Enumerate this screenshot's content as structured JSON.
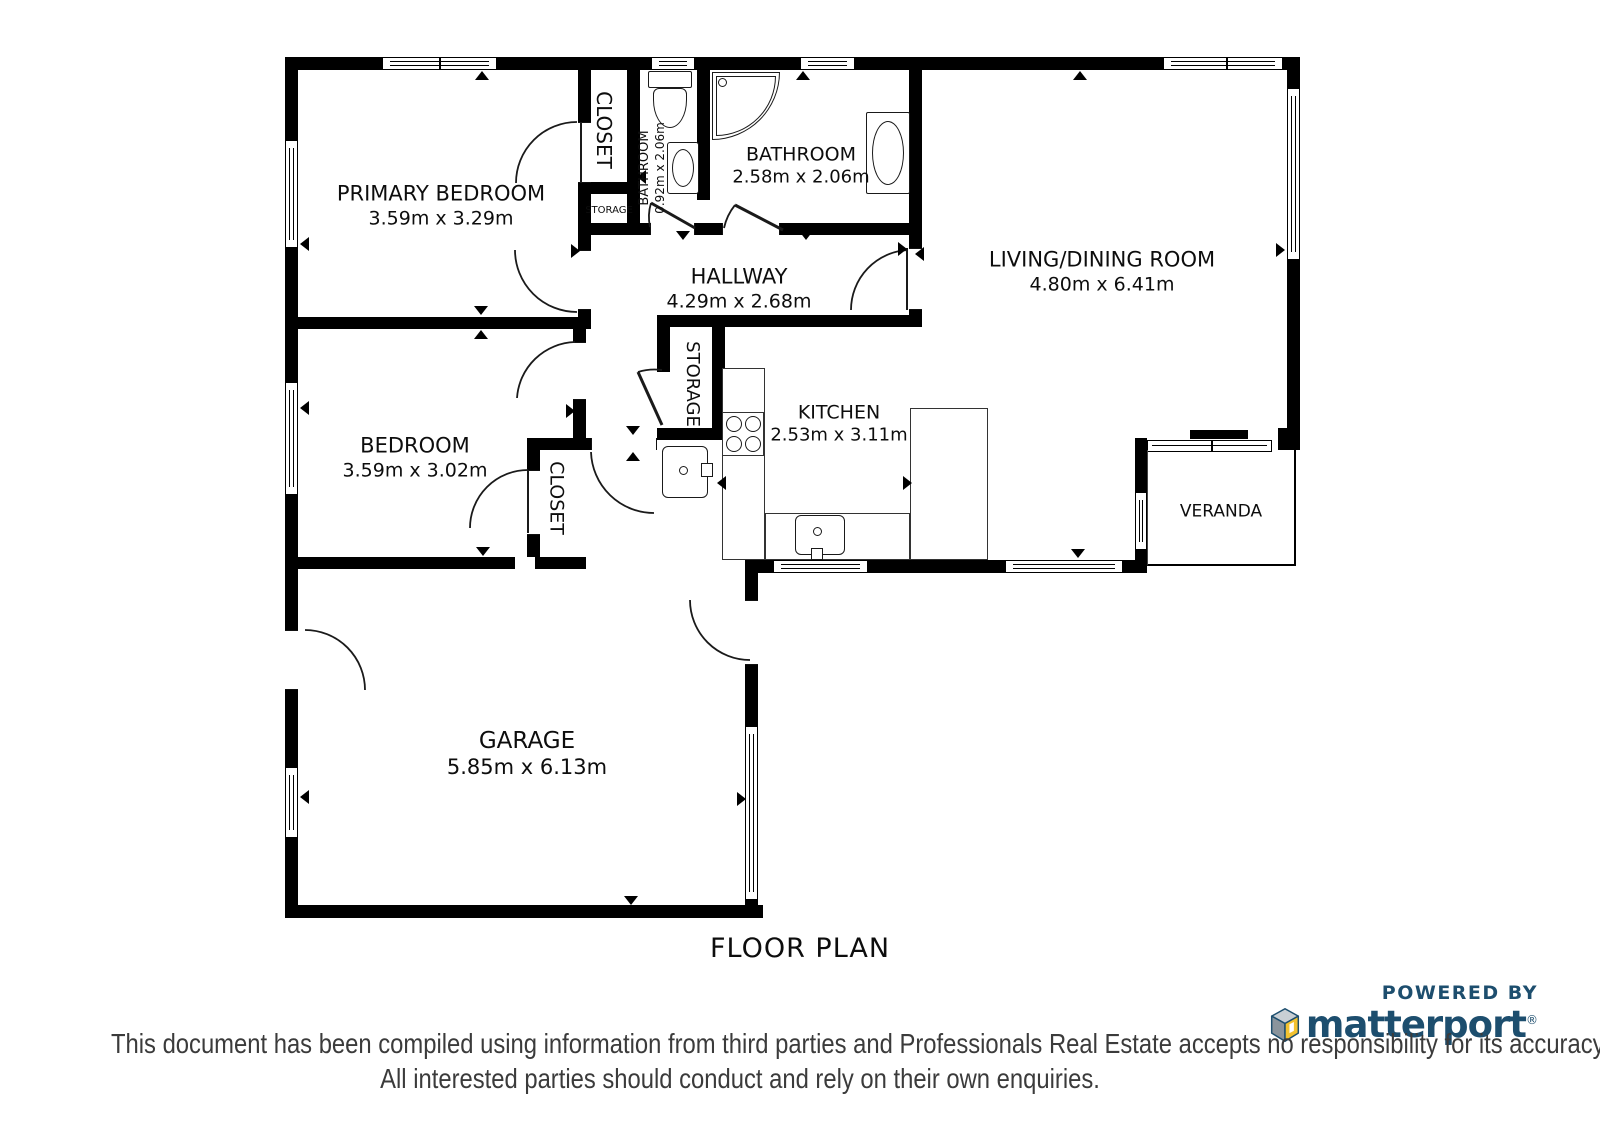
{
  "title": "FLOOR PLAN",
  "rooms": {
    "primary_bedroom": {
      "name": "PRIMARY BEDROOM",
      "dims": "3.59m x 3.29m"
    },
    "closet_top": {
      "name": "CLOSET"
    },
    "storage_small": {
      "name": "STORAGE"
    },
    "bathroom_small": {
      "name": "BATHROOM",
      "dims": "0.92m x 2.06m"
    },
    "bathroom": {
      "name": "BATHROOM",
      "dims": "2.58m x 2.06m"
    },
    "living_dining": {
      "name": "LIVING/DINING ROOM",
      "dims": "4.80m x 6.41m"
    },
    "hallway": {
      "name": "HALLWAY",
      "dims": "4.29m x 2.68m"
    },
    "storage_hall": {
      "name": "STORAGE"
    },
    "kitchen": {
      "name": "KITCHEN",
      "dims": "2.53m x 3.11m"
    },
    "bedroom": {
      "name": "BEDROOM",
      "dims": "3.59m x 3.02m"
    },
    "closet_bedroom": {
      "name": "CLOSET"
    },
    "veranda": {
      "name": "VERANDA"
    },
    "garage": {
      "name": "GARAGE",
      "dims": "5.85m x 6.13m"
    }
  },
  "footer": {
    "powered_by": "POWERED BY",
    "brand": "matterport",
    "registered_mark": "®",
    "disclaimer_line1": "This document has been compiled using information from third parties and Professionals Real Estate accepts no responsibility for its accuracy.",
    "disclaimer_line2": "All interested parties should conduct and rely on their own enquiries."
  },
  "colors": {
    "wall": "#000000",
    "line": "#1a1a1a",
    "brand_navy": "#1d4e6e",
    "brand_yellow": "#f2c230",
    "brand_gray_light": "#c9cfd4",
    "brand_gray_dark": "#8a949c",
    "disclaimer_text": "#3b3b3b"
  }
}
